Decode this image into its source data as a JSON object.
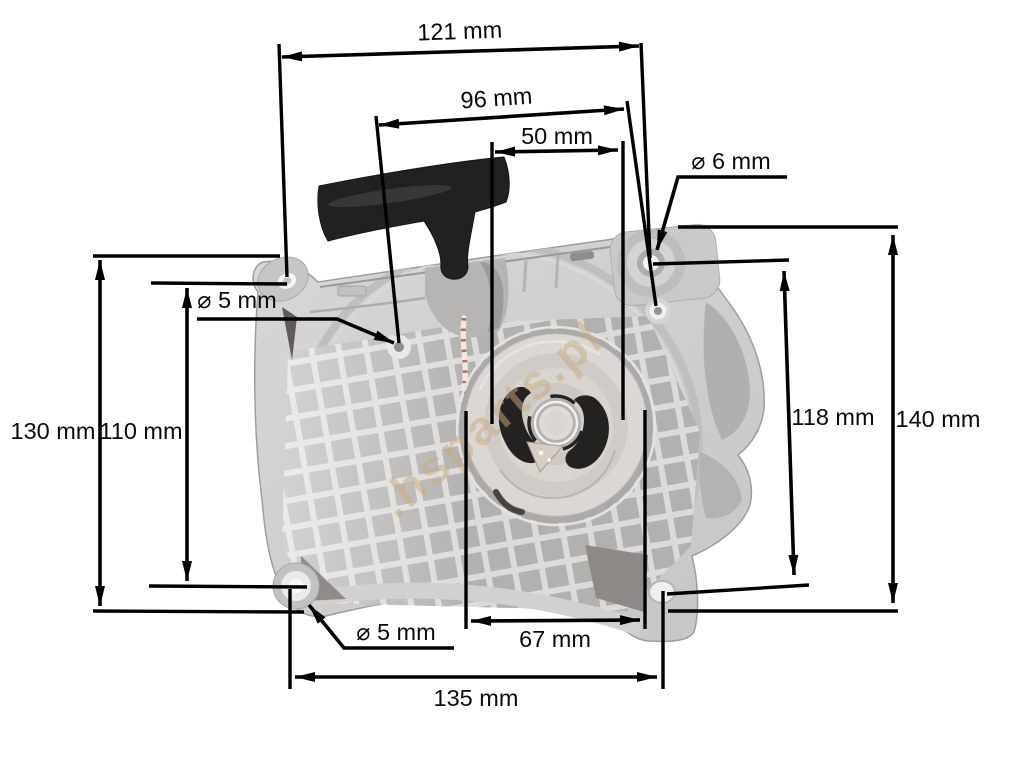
{
  "page": {
    "background": "#ffffff"
  },
  "diagram": {
    "watermark": ".hsparts.pl",
    "dimensions": {
      "top_width": "121 mm",
      "inner_top_width": "96 mm",
      "rope_to_hole_width": "50 mm",
      "pulley_width": "67 mm",
      "bottom_width": "135 mm",
      "left_height_outer": "130 mm",
      "left_height_holes": "110 mm",
      "right_height_holes": "118 mm",
      "right_height_outer": "140 mm",
      "hole_dia_top_right": "⌀ 6 mm",
      "hole_dia_top_left": "⌀ 5 mm",
      "hole_dia_bottom_left": "⌀ 5 mm"
    },
    "colors": {
      "dimension_line": "#000000",
      "housing": "#cfcecc",
      "handle": "#232120",
      "pulley": "#dcd9d4",
      "watermark": "#c9ab84"
    }
  }
}
